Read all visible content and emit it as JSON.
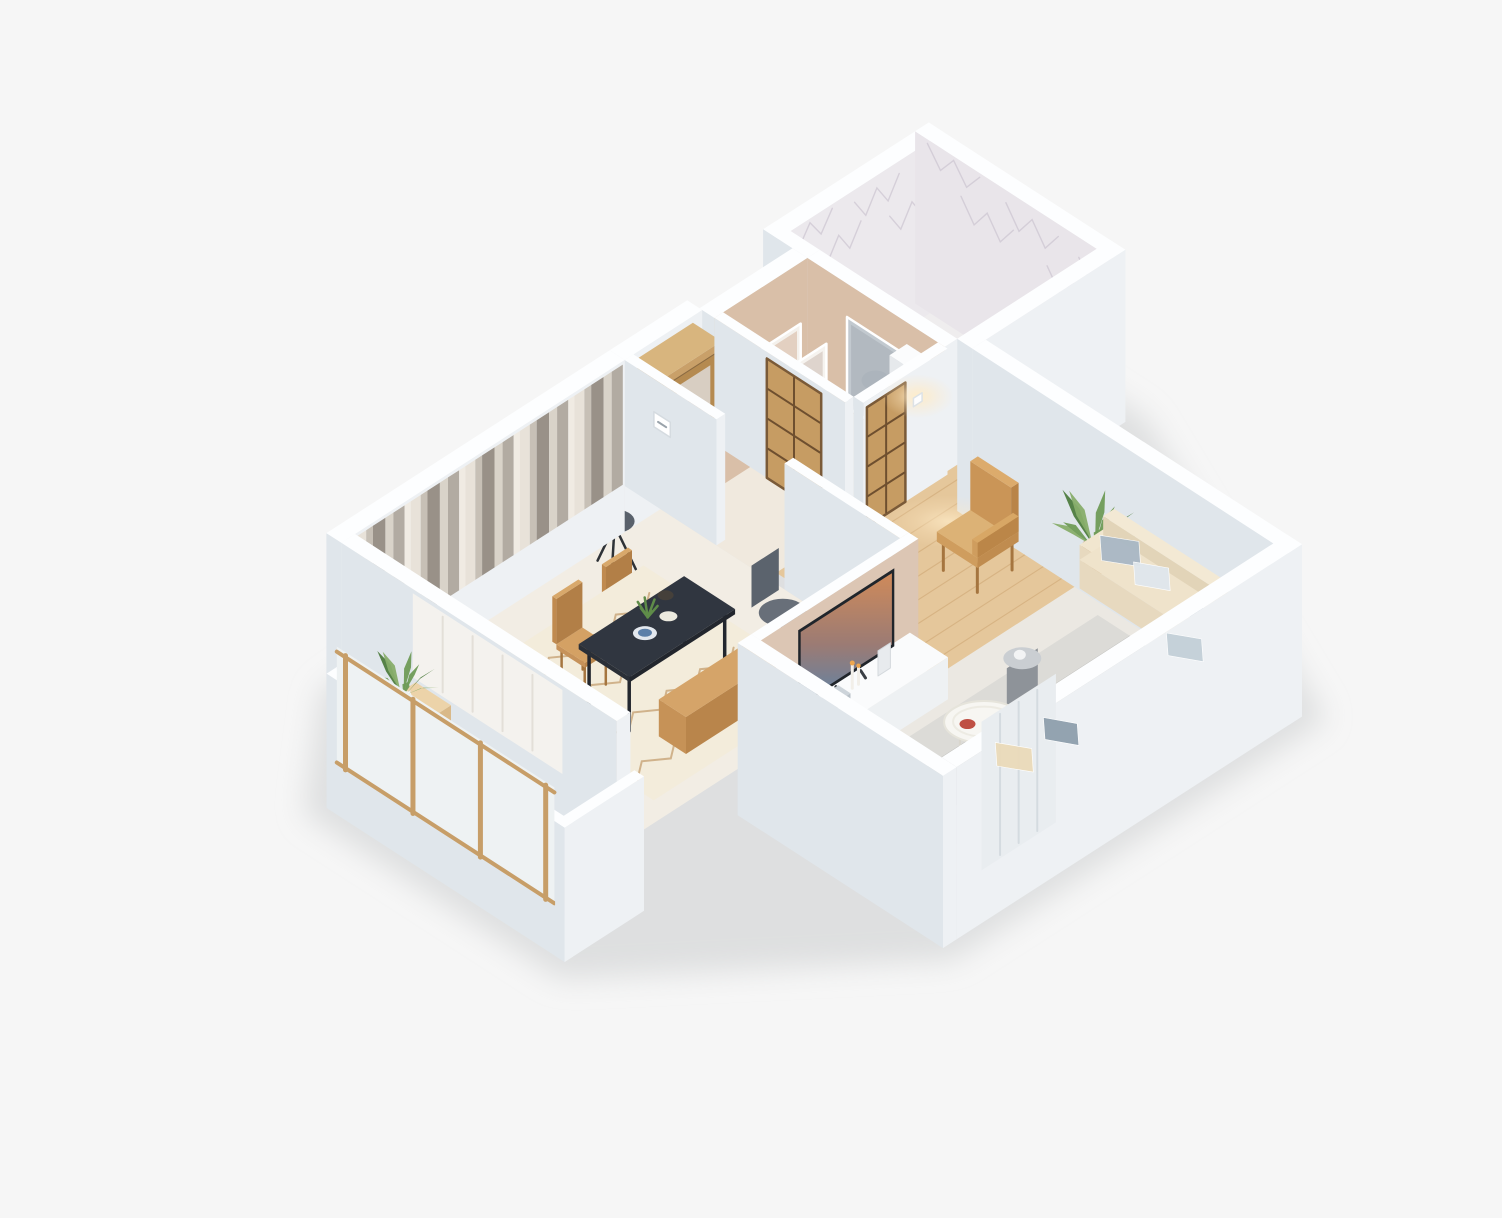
{
  "meta": {
    "title": "3D isometric dollhouse render of a one-bedroom apartment floor plan",
    "background": "#f6f6f6",
    "canvas_width": 1502,
    "canvas_height": 1218
  },
  "palette": {
    "background": "#f6f6f6",
    "wall_top": "#fdfeff",
    "wall_front": "#eef1f4",
    "wall_side": "#e0e6eb",
    "beige_wall": "#d9bfa8",
    "tv_wall": "#dcc6b4",
    "wood_floor": "#e5c79b",
    "sofa": "#ecdfc7",
    "dining_table": "#303640",
    "accent_wood": "#c9935a",
    "plant_green": "#5f8c49",
    "marble": "#ece9ed",
    "curtain_light": "#e8e2d9",
    "curtain_dark": "#999188"
  },
  "rooms": [
    {
      "id": "dining",
      "name": "Dining room"
    },
    {
      "id": "hall",
      "name": "Entry hall"
    },
    {
      "id": "dressing",
      "name": "Dressing area"
    },
    {
      "id": "bathroom",
      "name": "Bathroom"
    },
    {
      "id": "living",
      "name": "Living room"
    },
    {
      "id": "balcony",
      "name": "Balcony"
    }
  ],
  "scene": {
    "shadow": {
      "fill": "#caccce",
      "opacity": 0.55,
      "hull": [
        [
          -1.75,
          0.85
        ],
        [
          -0.1,
          -0.42
        ],
        [
          7.0,
          -0.7
        ],
        [
          9.98,
          -0.68
        ],
        [
          9.98,
          2.52
        ],
        [
          7.68,
          7.28
        ],
        [
          1.65,
          7.28
        ],
        [
          -1.75,
          4.62
        ]
      ]
    },
    "floors": [
      {
        "id": "floor-bathroom",
        "x1": 7.3,
        "y1": -0.25,
        "x2": 9.55,
        "y2": 2.2,
        "fill": "#efedee"
      },
      {
        "id": "floor-dressing",
        "x1": 5.74,
        "y1": 0.18,
        "x2": 7.1,
        "y2": 2.1,
        "fill": "#ece3d9"
      },
      {
        "id": "floor-hall",
        "x1": 4.35,
        "y1": 0,
        "x2": 5.74,
        "y2": 2.1,
        "fill": "#f0e9de"
      },
      {
        "id": "floor-dining",
        "x1": 0,
        "y1": 0,
        "x2": 4.35,
        "y2": 4.05,
        "fill": "#f2ede4",
        "shade": {
          "y1": 0,
          "y2": 0.32,
          "fill": "#b9b0a4",
          "op": 0.16
        }
      },
      {
        "id": "floor-living",
        "x1": 1.95,
        "y1": 4.19,
        "x2": 7.3,
        "y2": 6.85,
        "fill": "#ebe8e2"
      },
      {
        "id": "floor-living-wood",
        "x1": 4.49,
        "y1": 2.1,
        "x2": 7.3,
        "y2": 4.45,
        "fill": "#e5c79b",
        "planks": {
          "dir": "x",
          "step": 0.27,
          "stroke": "#c9a06b"
        }
      },
      {
        "id": "floor-balcony",
        "x1": -1.36,
        "y1": 1.09,
        "x2": -0.22,
        "y2": 4.31,
        "fill": "#eedcbc",
        "planks": {
          "dir": "y",
          "step": 0.23,
          "stroke": "#d6b488"
        }
      }
    ],
    "walls": [
      {
        "id": "wall-dining-nw",
        "x1": -0.22,
        "y1": -0.22,
        "x2": 4.35,
        "y2": 0,
        "base": -0.55,
        "h": 1.5,
        "decor": [
          {
            "type": "curtains",
            "face": "front",
            "u1": 0.02,
            "u2": 4.32
          }
        ]
      },
      {
        "id": "wall-hall-nw",
        "x1": 4.35,
        "y1": -0.22,
        "x2": 5.6,
        "y2": 0,
        "base": -0.55,
        "h": 1.5
      },
      {
        "id": "wall-dressing-nw",
        "x1": 5.6,
        "y1": -0.04,
        "x2": 7.1,
        "y2": 0.18,
        "base": -0.55,
        "h": 1.5,
        "front": "#d9bfa8"
      },
      {
        "id": "wall-bathroom-nw",
        "x1": 7.1,
        "y1": -0.47,
        "x2": 9.77,
        "y2": -0.25,
        "base": -0.55,
        "h": 1.5,
        "front": "#ece9ed",
        "decor": [
          {
            "type": "marble",
            "face": "front",
            "u1": 7.15,
            "u2": 9.72
          }
        ]
      },
      {
        "id": "wall-bathroom-ne",
        "x1": 9.55,
        "y1": -0.47,
        "x2": 9.77,
        "y2": 2.42,
        "base": -0.55,
        "h": 1.5,
        "left": "#e9e5ea",
        "decor": [
          {
            "type": "marble",
            "face": "left",
            "u1": -0.4,
            "u2": 2.35
          }
        ]
      },
      {
        "id": "wall-bathroom-se",
        "x1": 7.3,
        "y1": 2.2,
        "x2": 9.77,
        "y2": 2.42,
        "base": -0.55,
        "h": 1.5
      },
      {
        "id": "wall-living-ne",
        "x1": 7.3,
        "y1": 2.42,
        "x2": 7.52,
        "y2": 7.07,
        "base": -0.55,
        "h": 1.5
      },
      {
        "id": "wall-living-se",
        "x1": 1.95,
        "y1": 6.85,
        "x2": 7.52,
        "y2": 7.07,
        "base": -0.55,
        "h": 1.5,
        "decor": [
          {
            "type": "panels",
            "face": "front",
            "u1": 2.35,
            "u2": 3.55
          }
        ]
      },
      {
        "id": "wall-living-sw",
        "x1": 1.73,
        "y1": 4.05,
        "x2": 1.95,
        "y2": 7.07,
        "base": -0.55,
        "h": 1.5
      },
      {
        "id": "wall-dining-sw",
        "x1": -0.22,
        "y1": 0,
        "x2": 0,
        "y2": 4.05,
        "base": -0.55,
        "h": 1.5,
        "decor": [
          {
            "type": "glass",
            "face": "left",
            "u1": 1.05,
            "u2": 3.25
          }
        ]
      },
      {
        "id": "wall-tv",
        "x1": 1.95,
        "y1": 4.05,
        "x2": 4.49,
        "y2": 4.19,
        "base": 0,
        "h": 1.5,
        "front": "#dcc6b4"
      },
      {
        "id": "wall-hall-dining",
        "x1": 4.35,
        "y1": 0,
        "x2": 4.49,
        "y2": 1.35,
        "base": 0,
        "h": 1.5,
        "decor": [
          {
            "type": "thermostat",
            "face": "left",
            "u": 0.55,
            "z": 1.02
          }
        ]
      },
      {
        "id": "wall-dining-living",
        "x1": 4.35,
        "y1": 2.35,
        "x2": 4.49,
        "y2": 4.05,
        "base": 0,
        "h": 1.5
      },
      {
        "id": "wall-hall-dressing",
        "x1": 5.6,
        "y1": 0.18,
        "x2": 5.74,
        "y2": 2.1,
        "base": 0,
        "h": 1.5,
        "decor": [
          {
            "type": "shoji",
            "face": "left",
            "u1": 0.95,
            "u2": 1.75,
            "h": 1.42
          }
        ]
      },
      {
        "id": "wall-dressing-living",
        "x1": 5.74,
        "y1": 2.1,
        "x2": 7.1,
        "y2": 2.24,
        "base": 0,
        "h": 1.5,
        "decor": [
          {
            "type": "shoji",
            "face": "front",
            "u1": 5.8,
            "u2": 6.42,
            "h": 1.42
          },
          {
            "type": "sconce",
            "face": "front",
            "u": 6.62,
            "z": 1.12
          }
        ]
      },
      {
        "id": "wall-bathroom-w-upper",
        "x1": 7.1,
        "y1": -0.47,
        "x2": 7.3,
        "y2": 0.18,
        "base": -0.55,
        "h": 1.5
      },
      {
        "id": "wall-dressing-ne",
        "x1": 7.1,
        "y1": 0.18,
        "x2": 7.3,
        "y2": 2.2,
        "base": 0,
        "h": 1.5,
        "left": "#d9bfa8"
      },
      {
        "id": "wall-balcony-outer",
        "x1": -1.5,
        "y1": 0.95,
        "x2": -1.36,
        "y2": 4.45,
        "base": -0.55,
        "h": 1.05,
        "decor": [
          {
            "type": "woodframe",
            "face": "left",
            "u1": 1.1,
            "u2": 4.3
          }
        ]
      },
      {
        "id": "wall-balcony-nw",
        "x1": -1.36,
        "y1": 0.95,
        "x2": -0.22,
        "y2": 1.09,
        "base": -0.55,
        "h": 1.05
      },
      {
        "id": "wall-balcony-se",
        "x1": -1.5,
        "y1": 4.31,
        "x2": -0.22,
        "y2": 4.45,
        "base": -0.55,
        "h": 1.05
      }
    ],
    "furniture": [
      {
        "id": "dining-rug",
        "type": "rug",
        "x1": 0.65,
        "y1": 1.05,
        "x2": 3.5,
        "y2": 3.8,
        "fill": "#f3ecdb",
        "zigzag": "#c9a87d"
      },
      {
        "id": "dining-table",
        "type": "table",
        "x1": 1.25,
        "y1": 2.15,
        "x2": 2.95,
        "y2": 2.9,
        "z": 0.72,
        "top": "#303640",
        "side": "#22262d",
        "left": "#2a2f37",
        "legs": "#23272e"
      },
      {
        "id": "dining-chair-1",
        "type": "chair",
        "cx": 1.55,
        "cy": 1.95
      },
      {
        "id": "dining-chair-2",
        "type": "chair",
        "cx": 2.35,
        "cy": 1.95
      },
      {
        "id": "dining-bench",
        "type": "box",
        "x1": 1.5,
        "y1": 3.1,
        "x2": 2.95,
        "y2": 3.5,
        "z1": 0,
        "z2": 0.44,
        "top": "#d5a469",
        "front": "#b9854b",
        "left": "#c69257"
      },
      {
        "id": "dining-tableware",
        "type": "tableware",
        "cx": 2.0,
        "cy": 2.45,
        "z": 0.76,
        "kb": 0.5
      },
      {
        "id": "stool-chair",
        "type": "stool",
        "cx": 3.2,
        "cy": 0.9
      },
      {
        "id": "desk",
        "type": "box",
        "x1": 3.5,
        "y1": 3.5,
        "x2": 4.32,
        "y2": 3.95,
        "z1": 0,
        "z2": 0.72,
        "top": "#f7f8f9",
        "front": "#e9ecee",
        "left": "#eceff1"
      },
      {
        "id": "office-chair",
        "type": "officechair",
        "cx": 3.5,
        "cy": 3.1,
        "kb": 0.6
      },
      {
        "id": "wardrobe",
        "type": "wardrobe",
        "x1": 4.55,
        "y1": 0,
        "x2": 5.45,
        "y2": 0.42,
        "z1": 0,
        "z2": 1.42
      },
      {
        "id": "art-frame-1",
        "type": "frame",
        "face": "y",
        "x1": 5.9,
        "x2": 6.75,
        "yf": 0.4,
        "z1": 0.05,
        "z2": 1.0,
        "frame": "#f4f1ec",
        "inner": "#e3d0c1",
        "accent": "#dfa37c"
      },
      {
        "id": "art-frame-2",
        "type": "frame",
        "face": "y",
        "x1": 6.4,
        "x2": 7.0,
        "yf": 0.55,
        "z1": 0.04,
        "z2": 0.72,
        "frame": "#f6f3ef",
        "inner": "#ded4cd",
        "accent": "#c8b39e",
        "kb": 0.4
      },
      {
        "id": "mirror-panel",
        "type": "frame",
        "face": "x",
        "y1": 0.78,
        "y2": 1.62,
        "xf": 7.08,
        "z1": 0.05,
        "z2": 1.12,
        "frame": "#c2c9cf",
        "inner": "#b2b9c0",
        "accent": "#a8b0b8"
      },
      {
        "id": "dressing-cabinet",
        "type": "box",
        "x1": 6.8,
        "y1": 1.66,
        "x2": 7.08,
        "y2": 2.08,
        "z1": 0,
        "z2": 1.26,
        "top": "#fbfcfd",
        "front": "#eef1f3",
        "left": "#e6e9ec"
      },
      {
        "id": "floor-lamp",
        "type": "lamp",
        "cx": 6.9,
        "cy": 1.35
      },
      {
        "id": "light-pool",
        "type": "pool",
        "cx": 6.5,
        "cy": 2.8,
        "rx": 60,
        "ry": 26
      },
      {
        "id": "armchair",
        "type": "armchair",
        "cx": 6.15,
        "cy": 3.55
      },
      {
        "id": "plant-large",
        "type": "plant",
        "cx": 6.98,
        "cy": 4.5,
        "z": 0,
        "s": 1.0,
        "pot": {
          "r": 0.17,
          "h": 0.4,
          "fill": "#bc8d58",
          "top": "#a87c4b"
        }
      },
      {
        "id": "tv-console",
        "type": "box",
        "x1": 2.3,
        "y1": 4.24,
        "x2": 4.3,
        "y2": 4.8,
        "z1": 0,
        "z2": 0.5,
        "top": "#fafbfc",
        "front": "#eef1f3",
        "left": "#e7eaed"
      },
      {
        "id": "console-decor",
        "type": "consoledecor",
        "cx": 3.2,
        "cy": 4.45,
        "kb": 0.6
      },
      {
        "id": "tv",
        "type": "tv",
        "x1": 2.4,
        "x2": 3.95,
        "yf": 4.33,
        "z1": 0.55,
        "z2": 1.48,
        "kb": 0.5
      },
      {
        "id": "living-rug",
        "type": "rug",
        "x1": 2.55,
        "y1": 4.95,
        "x2": 6.55,
        "y2": 6.6,
        "fill": "#dcdbd7",
        "band": {
          "y1": 5.42,
          "y2": 6.08,
          "fill": "#bdbdba"
        }
      },
      {
        "id": "sofa-base-long",
        "type": "box",
        "x1": 3.05,
        "y1": 6.3,
        "x2": 7.18,
        "y2": 6.85,
        "z1": 0.12,
        "z2": 0.46,
        "top": "#efe3cb",
        "front": "#decfb1",
        "left": "#e7d9bf"
      },
      {
        "id": "sofa-back-long",
        "type": "box",
        "x1": 3.05,
        "y1": 6.66,
        "x2": 7.18,
        "y2": 6.85,
        "z1": 0.46,
        "z2": 0.8,
        "top": "#f3e9d4",
        "front": "#dccdae",
        "left": "#e4d6bb",
        "kb": 0.1
      },
      {
        "id": "sofa-base-right",
        "type": "box",
        "x1": 6.62,
        "y1": 4.62,
        "x2": 7.18,
        "y2": 6.3,
        "z1": 0.12,
        "z2": 0.46,
        "top": "#efe3cb",
        "front": "#e2d3b6",
        "left": "#e7d9bf"
      },
      {
        "id": "sofa-arm-right",
        "type": "box",
        "x1": 6.62,
        "y1": 4.62,
        "x2": 7.18,
        "y2": 4.8,
        "z1": 0.46,
        "z2": 0.64,
        "top": "#f1e6cf",
        "front": "#e0d1b3",
        "left": "#e7d9bf"
      },
      {
        "id": "sofa-back-right",
        "type": "box",
        "x1": 7.0,
        "y1": 4.62,
        "x2": 7.18,
        "y2": 6.3,
        "z1": 0.46,
        "z2": 0.8,
        "top": "#f3e9d4",
        "front": "#dccdae",
        "left": "#e2d4b8"
      },
      {
        "id": "pillow-1",
        "type": "pillow",
        "cx": 6.86,
        "cy": 5.0,
        "z": 0.62,
        "s": 0.3,
        "fill": "#a9b8c4",
        "kb": 2
      },
      {
        "id": "pillow-2",
        "type": "pillow",
        "cx": 6.82,
        "cy": 5.5,
        "z": 0.6,
        "s": 0.27,
        "fill": "#dfe6eb",
        "kb": 2
      },
      {
        "id": "pillow-3",
        "type": "pillow",
        "cx": 6.7,
        "cy": 6.45,
        "z": 0.62,
        "s": 0.3,
        "fill": "#93a5b2",
        "kb": 2
      },
      {
        "id": "pillow-4",
        "type": "pillow",
        "cx": 6.2,
        "cy": 6.55,
        "z": 0.6,
        "s": 0.27,
        "fill": "#c3cfd8",
        "kb": 2
      },
      {
        "id": "pillow-5",
        "type": "pillow",
        "cx": 3.45,
        "cy": 6.55,
        "z": 0.6,
        "s": 0.28,
        "fill": "#e9daba",
        "kb": 2
      },
      {
        "id": "pillow-6",
        "type": "pillow",
        "cx": 4.15,
        "cy": 6.6,
        "z": 0.6,
        "s": 0.26,
        "fill": "#8fa0ad",
        "kb": 2
      },
      {
        "id": "tray-table",
        "type": "traytable",
        "cx": 3.95,
        "cy": 5.65,
        "kb": 0.5
      },
      {
        "id": "side-table",
        "type": "sidetable",
        "cx": 4.95,
        "cy": 5.3,
        "kb": 1.2
      },
      {
        "id": "balcony-bench",
        "type": "box",
        "x1": -1.33,
        "y1": 1.12,
        "x2": -0.25,
        "y2": 1.64,
        "z1": 0,
        "z2": 0.44,
        "top": "#ecd3a9",
        "front": "#d9b989",
        "left": "#e2c89c"
      },
      {
        "id": "balcony-plant",
        "type": "plant",
        "cx": -0.75,
        "cy": 1.38,
        "z": 0.44,
        "s": 0.8,
        "pot": {
          "r": 0.13,
          "h": 0.22,
          "fill": "#e8ebed",
          "top": "#f6f8f9"
        },
        "kb": 0.4
      }
    ]
  }
}
